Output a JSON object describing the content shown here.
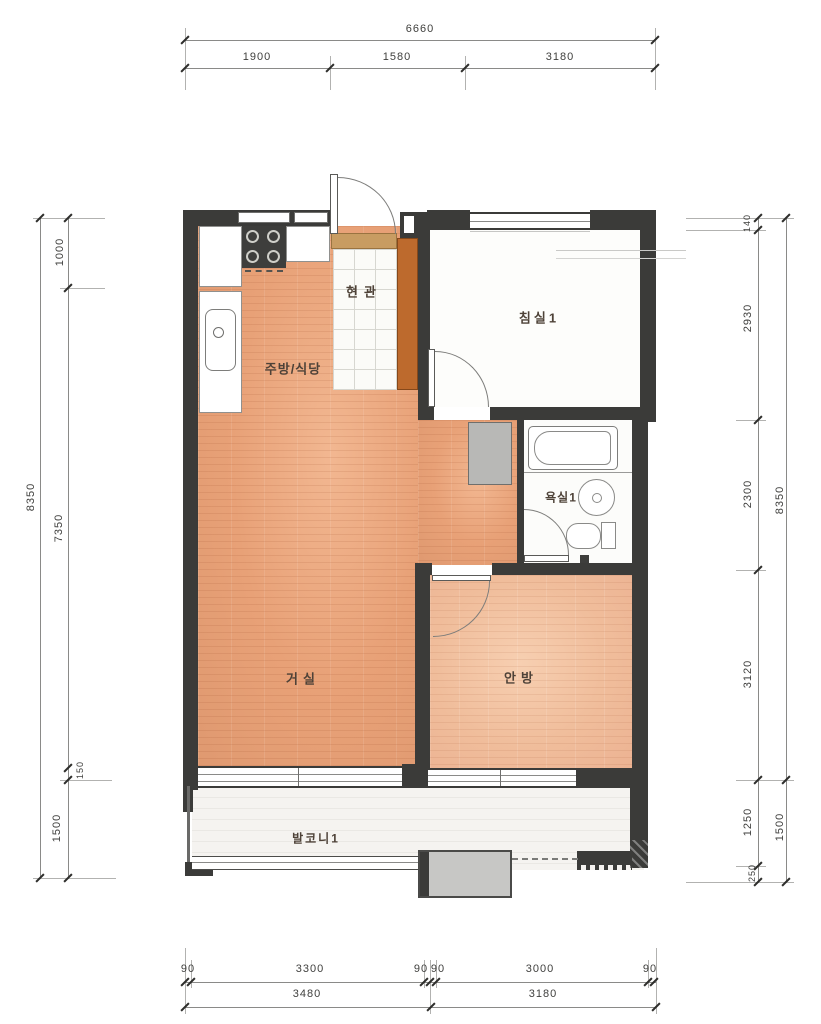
{
  "title": "apartment-unit-floor-plan",
  "rooms": {
    "entrance": "현관",
    "bedroom1": "침실1",
    "kitchen": "주방/식당",
    "bathroom": "욕실1",
    "living": "거실",
    "master": "안방",
    "balcony": "발코니1"
  },
  "dims": {
    "top": {
      "total": "6660",
      "s1": "1900",
      "s2": "1580",
      "s3": "3180"
    },
    "left": {
      "outer": "8350",
      "s1": "1000",
      "s2": "7350",
      "s3": "150",
      "s4": "1500"
    },
    "right": {
      "s1": "140",
      "s2": "2930",
      "s3": "2300",
      "s4": "3120",
      "s5": "1250",
      "s6": "250",
      "outer_top": "8350",
      "outer_bottom": "1500"
    },
    "bottom": {
      "s1": "90",
      "s2": "3300",
      "s3": "90",
      "s4": "90",
      "s5": "3000",
      "s6": "90",
      "t1": "3480",
      "t2": "3180"
    }
  },
  "colors": {
    "wall": "#3b3b39",
    "wood_floor": "#e8a177",
    "master_floor": "#f0bd9b",
    "cabinet_accent": "#bd6a2d",
    "duct_gray": "#b8b8b6",
    "balcony_floor": "#f5f3f0"
  }
}
